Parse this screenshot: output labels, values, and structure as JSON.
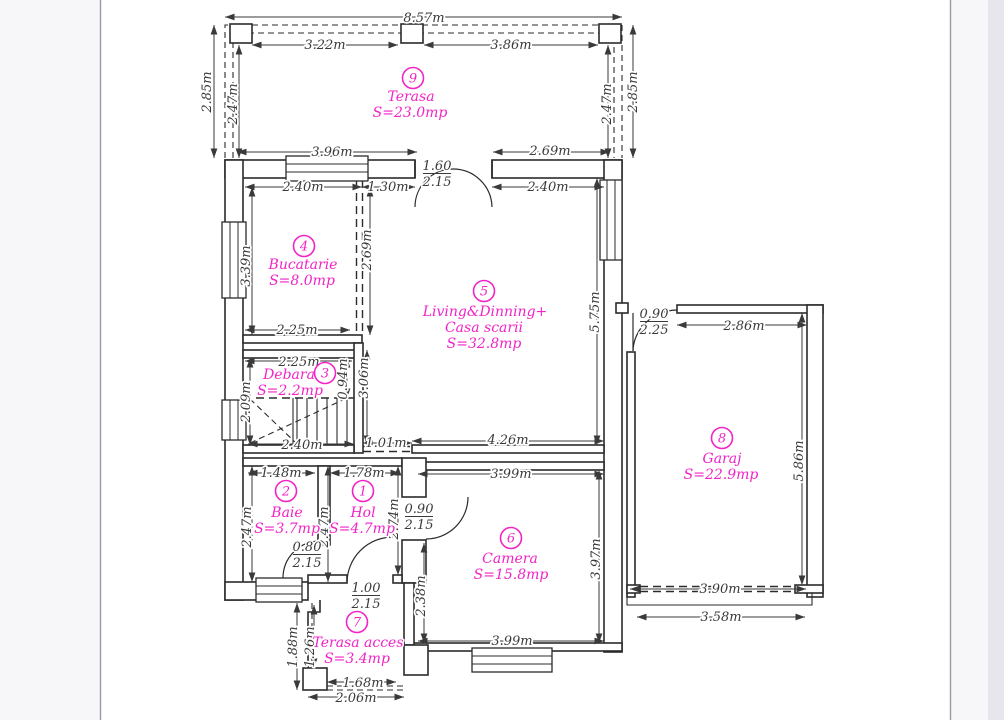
{
  "page": {
    "background": "#f7f7f9",
    "paper": "#ffffff",
    "border_color": "#9b9ba4",
    "accent_magenta": "#f223c7",
    "line_color": "#2b2b2b",
    "dim_text_color": "#3a3a3a"
  },
  "rooms": [
    {
      "num": "1",
      "name": "Hol",
      "area": "S=4.7mp"
    },
    {
      "num": "2",
      "name": "Baie",
      "area": "S=3.7mp"
    },
    {
      "num": "3",
      "name": "Debara",
      "area": "S=2.2mp"
    },
    {
      "num": "4",
      "name": "Bucatarie",
      "area": "S=8.0mp"
    },
    {
      "num": "5",
      "name": "Living&Dinning+",
      "name2": "Casa scarii",
      "area": "S=32.8mp"
    },
    {
      "num": "6",
      "name": "Camera",
      "area": "S=15.8mp"
    },
    {
      "num": "7",
      "name": "Terasa acces",
      "area": "S=3.4mp"
    },
    {
      "num": "8",
      "name": "Garaj",
      "area": "S=22.9mp"
    },
    {
      "num": "9",
      "name": "Terasa",
      "area": "S=23.0mp"
    }
  ],
  "dims": [
    {
      "id": "terasa-total-width",
      "text": "8.57m"
    },
    {
      "id": "terasa-span-left",
      "text": "3.22m"
    },
    {
      "id": "terasa-span-right",
      "text": "3.86m"
    },
    {
      "id": "terasa-outer-left",
      "text": "2.85m"
    },
    {
      "id": "terasa-inner-left",
      "text": "2.47m"
    },
    {
      "id": "terasa-inner-right",
      "text": "2.47m"
    },
    {
      "id": "terasa-outer-right",
      "text": "2.85m"
    },
    {
      "id": "terasa-bottom-left",
      "text": "3.96m"
    },
    {
      "id": "terasa-bottom-right",
      "text": "2.69m"
    },
    {
      "id": "kitchen-top",
      "text": "2.40m"
    },
    {
      "id": "kitchen-opening",
      "text": "1.30m"
    },
    {
      "id": "living-top",
      "text": "2.40m"
    },
    {
      "id": "kitchen-height",
      "text": "3.39m"
    },
    {
      "id": "kitchen-partition",
      "text": "2.69m"
    },
    {
      "id": "kitchen-bottom",
      "text": "2.25m"
    },
    {
      "id": "debara-top",
      "text": "2.25m"
    },
    {
      "id": "debara-left",
      "text": "2.09m"
    },
    {
      "id": "debara-right",
      "text": "0.94m"
    },
    {
      "id": "stair-hall-height",
      "text": "3.06m"
    },
    {
      "id": "living-height",
      "text": "5.75m"
    },
    {
      "id": "stairs-width",
      "text": "2.40m"
    },
    {
      "id": "stair-opening",
      "text": "1.01m"
    },
    {
      "id": "living-bottom",
      "text": "4.26m"
    },
    {
      "id": "camera-top",
      "text": "3.99m"
    },
    {
      "id": "baie-top",
      "text": "1.48m"
    },
    {
      "id": "hol-top",
      "text": "1.78m"
    },
    {
      "id": "baie-left",
      "text": "2.47m"
    },
    {
      "id": "baie-right",
      "text": "2.47m"
    },
    {
      "id": "hol-right",
      "text": "2.74m"
    },
    {
      "id": "camera-left",
      "text": "2.38m"
    },
    {
      "id": "camera-right",
      "text": "3.97m"
    },
    {
      "id": "camera-bottom",
      "text": "3.99m"
    },
    {
      "id": "garaj-top",
      "text": "2.86m"
    },
    {
      "id": "garaj-right",
      "text": "5.86m"
    },
    {
      "id": "garaj-door-width",
      "text": "3.90m"
    },
    {
      "id": "garaj-apron",
      "text": "3.58m"
    },
    {
      "id": "acces-left-outer",
      "text": "1.88m"
    },
    {
      "id": "acces-left-inner",
      "text": "1.26m"
    },
    {
      "id": "acces-bottom-inner",
      "text": "1.68m"
    },
    {
      "id": "acces-bottom-outer",
      "text": "2.06m"
    }
  ],
  "doors": [
    {
      "id": "terasa-living",
      "w": "1.60",
      "h": "2.15"
    },
    {
      "id": "baie",
      "w": "0.80",
      "h": "2.15"
    },
    {
      "id": "hol-camera",
      "w": "0.90",
      "h": "2.15"
    },
    {
      "id": "terasa-acces",
      "w": "1.00",
      "h": "2.15"
    },
    {
      "id": "living-garaj",
      "w": "0.90",
      "h": "2.25"
    }
  ]
}
